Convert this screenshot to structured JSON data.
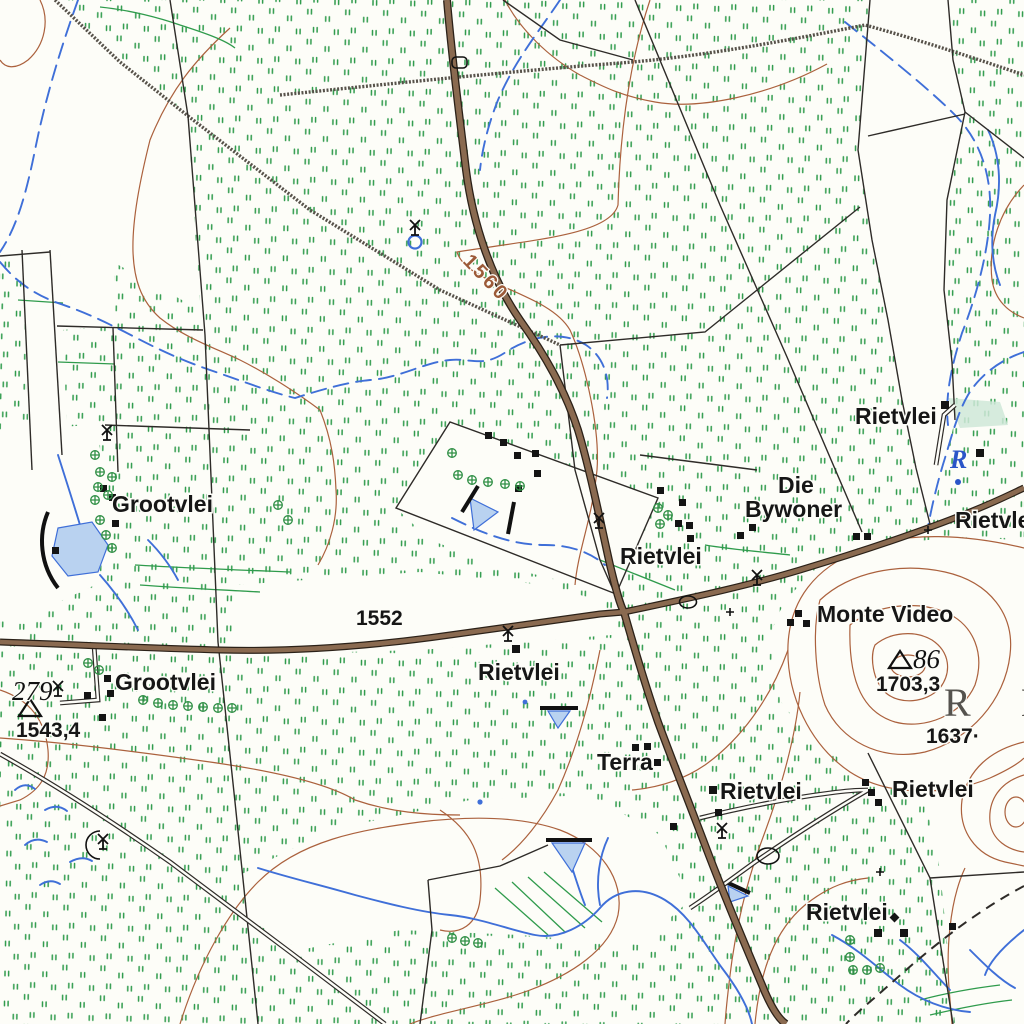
{
  "labels": {
    "grootvlei_north": "Grootvlei",
    "grootvlei_south": "Grootvlei",
    "rietvlei_upper": "Rietvlei",
    "rietvlei_east_edge": "Rietvlei",
    "rietvlei_west_of_junction": "Rietvlei",
    "rietvlei_south_of_road": "Rietvlei",
    "die_bywoner_line1": "Die",
    "die_bywoner_line2": "Bywoner",
    "monte_video": "Monte Video",
    "terra": "Terra",
    "rietvlei_center_south": "Rietvlei",
    "rietvlei_southeast": "Rietvlei",
    "rietvlei_bottom": "Rietvlei",
    "region_letters": "R I",
    "river_initial": "R"
  },
  "hypsography": {
    "contour_label": "1560",
    "spot_height": "1637·",
    "strip_number": "1552"
  },
  "trig_beacons": {
    "west": {
      "number": "279",
      "elevation": "1543,4"
    },
    "monte_video": {
      "number": "86",
      "elevation": "1703,3"
    }
  },
  "colors": {
    "vegetation_green": "#2f9b4c",
    "road_brown": "#8a6a50",
    "water_blue": "#3f6fd8",
    "contour_brown": "#ab613d",
    "boundary_black": "#2e2b28"
  },
  "symbols": {
    "windpump": "windpump-icon",
    "trig_beacon": "trig-beacon-icon",
    "building": "building-square",
    "tree": "tree-icon",
    "dam": "dam-area",
    "kraal": "kraal-icon"
  }
}
